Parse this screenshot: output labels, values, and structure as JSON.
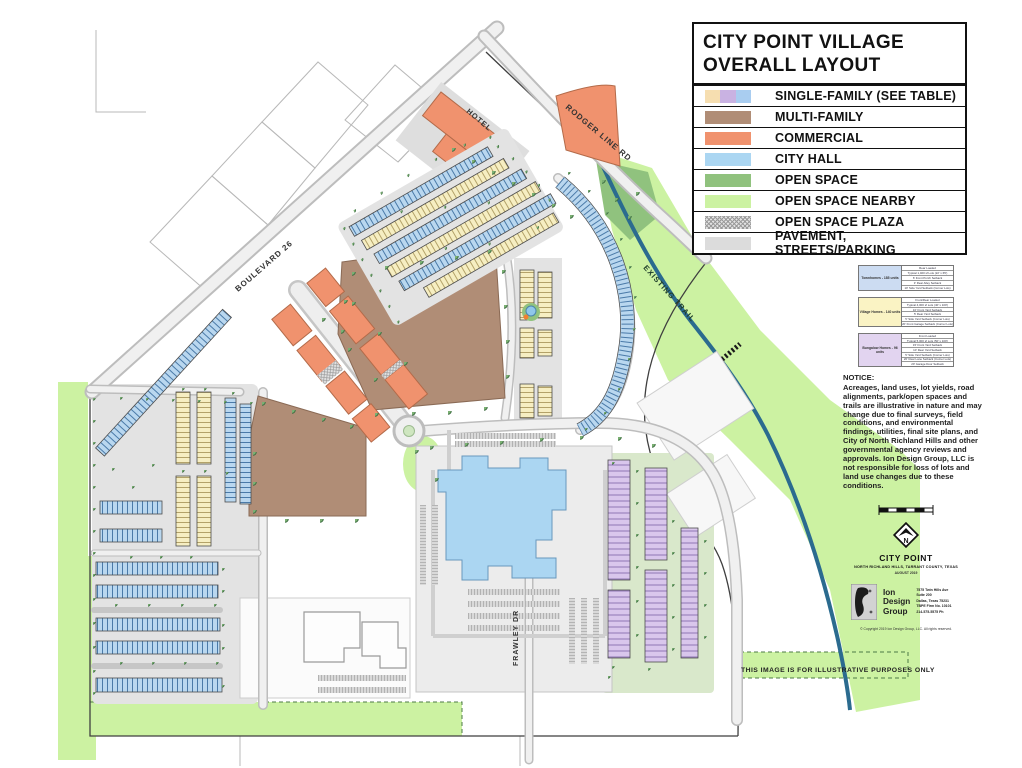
{
  "title_panel": {
    "line1": "CITY POINT VILLAGE",
    "line2": "OVERALL LAYOUT"
  },
  "legend": {
    "items": [
      {
        "label": "SINGLE-FAMILY (SEE TABLE)",
        "swatch": [
          "#f6deb0",
          "#c9b2e2",
          "#a9cdf0"
        ]
      },
      {
        "label": "MULTI-FAMILY",
        "swatch": "#b08d76"
      },
      {
        "label": "COMMERCIAL",
        "swatch": "#f0926e"
      },
      {
        "label": "CITY HALL",
        "swatch": "#abd6f2"
      },
      {
        "label": "OPEN SPACE",
        "swatch": "#90c27e"
      },
      {
        "label": "OPEN SPACE NEARBY",
        "swatch": "#ccf2a2"
      },
      {
        "label": "OPEN SPACE PLAZA",
        "swatch": "gray-crosshatch"
      },
      {
        "label": "PAVEMENT, STREETS/PARKING",
        "swatch": "#dcdcdc"
      }
    ]
  },
  "palette": {
    "single_family_yellow": "#f6eec2",
    "single_family_purple": "#d9c6ec",
    "single_family_blue": "#b9d7ef",
    "multi_family": "#b08d76",
    "commercial": "#f0926e",
    "city_hall": "#abd6f2",
    "open_space": "#90c27e",
    "open_space_nearby": "#ccf2a2",
    "pavement": "#dcdcdc",
    "trail_blue": "#2b6b8f"
  },
  "unit_tables": [
    {
      "label": "Townhomes - 185 units",
      "rows": [
        "Rear Loaded",
        "Typical 1,400 sf Lots (22' x 65')",
        "6' Front Porch Setback",
        "3' Rear Alley Setback",
        "10' Side Yard Setback (Corner Lots)"
      ]
    },
    {
      "label": "Village Homes - 140 units",
      "rows": [
        "Front/Rear Loaded",
        "Typical 4,000 sf Lots (40' x 100')",
        "10' Front Yard Setback",
        "5' Rear Yard Setback",
        "5' Side Yard Setback (Corner Lots)",
        "20' Front Garage Setback (Corner Lots)"
      ]
    },
    {
      "label": "Bungalow Homes - 96 units",
      "rows": [
        "Front Loaded",
        "Typical 5,000 sf Lots (50' x 100')",
        "15' Front Yard Setback",
        "10' Rear Yard Setback",
        "5' Side Yard Setback (Corner Lots)",
        "20' Rear Lane Setback (Corner Lots)",
        "20' Garage Door Setback"
      ]
    }
  ],
  "notice": {
    "heading": "NOTICE:",
    "body": "Acreages, land uses, lot yields, road alignments, park/open spaces and trails are illustrative in nature and may change due to final surveys, field conditions, and environmental findings, utilities, final site plans, and City of North Richland Hills and other governmental agency reviews and approvals. Ion Design Group, LLC is not responsible for loss of lots and land use changes due to these conditions."
  },
  "map_labels": {
    "boulevard": "BOULEVARD 26",
    "rodger": "RODGER LINE RD",
    "hotel": "HOTEL",
    "trail": "EXISTING TRAIL",
    "frawley": "FRAWLEY DR"
  },
  "title_block": {
    "project": "CITY POINT",
    "location": "NORTH RICHLAND HILLS, TARRANT COUNTY, TEXAS",
    "date": "AUGUST 2019",
    "firm_name_lines": [
      "Ion",
      "Design",
      "Group"
    ],
    "firm_address": [
      "7575 Twin Hills Ave",
      "Suite 200",
      "Dallas, Texas 75231",
      "TBPE Firm No. 10101",
      "214-575-5575 Ph"
    ],
    "copyright": "© Copyright 2019   Ion Design Group, LLC.   All rights reserved."
  },
  "disclaimer": "THIS IMAGE IS FOR ILLUSTRATIVE PURPOSES ONLY"
}
